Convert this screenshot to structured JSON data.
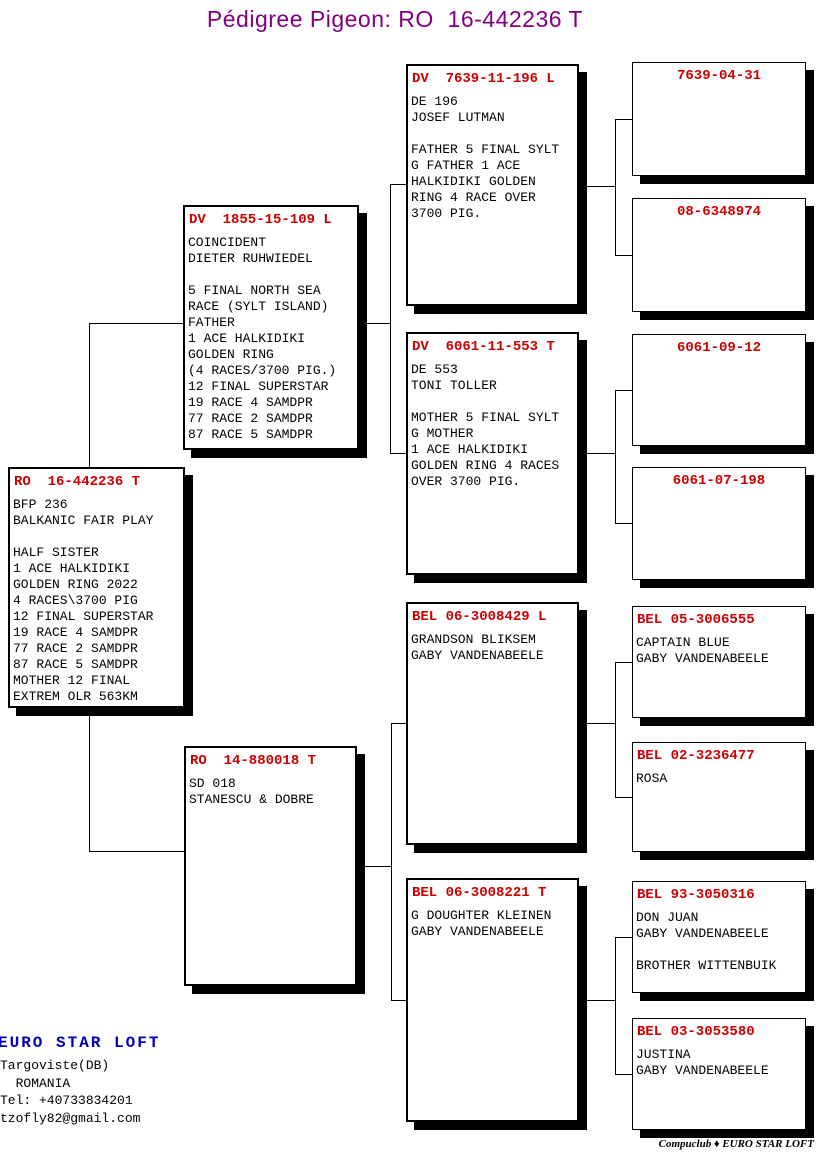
{
  "title": "Pédigree Pigeon: RO  16-442236 T",
  "colors": {
    "title_purple": "#800080",
    "ring_red": "#cc0000",
    "loft_blue": "#0000bb",
    "line_black": "#000000",
    "box_bg": "#ffffff"
  },
  "boxes": {
    "subject": {
      "ring": "RO  16-442236 T",
      "body": "BFP 236\nBALKANIC FAIR PLAY\n\nHALF SISTER\n1 ACE HALKIDIKI\nGOLDEN RING 2022\n4 RACES\\3700 PIG\n12 FINAL SUPERSTAR\n19 RACE 4 SAMDPR\n77 RACE 2 SAMDPR\n87 RACE 5 SAMDPR\nMOTHER 12 FINAL\nEXTREM OLR 563KM"
    },
    "sire": {
      "ring": "DV  1855-15-109 L",
      "body": "COINCIDENT\nDIETER RUHWIEDEL\n\n5 FINAL NORTH SEA\nRACE (SYLT ISLAND)\nFATHER\n1 ACE HALKIDIKI\nGOLDEN RING\n(4 RACES/3700 PIG.)\n12 FINAL SUPERSTAR\n19 RACE 4 SAMDPR\n77 RACE 2 SAMDPR\n87 RACE 5 SAMDPR"
    },
    "dam": {
      "ring": "RO  14-880018 T",
      "body": "SD 018\nSTANESCU & DOBRE"
    },
    "sire_sire": {
      "ring": "DV  7639-11-196 L",
      "body": "DE 196\nJOSEF LUTMAN\n\nFATHER 5 FINAL SYLT\nG FATHER 1 ACE\nHALKIDIKI GOLDEN\nRING 4 RACE OVER\n3700 PIG."
    },
    "sire_dam": {
      "ring": "DV  6061-11-553 T",
      "body": "DE 553\nTONI TOLLER\n\nMOTHER 5 FINAL SYLT\nG MOTHER\n1 ACE HALKIDIKI\nGOLDEN RING 4 RACES\nOVER 3700 PIG."
    },
    "dam_sire": {
      "ring": "BEL 06-3008429 L",
      "body": "GRANDSON BLIKSEM\nGABY VANDENABEELE"
    },
    "dam_dam": {
      "ring": "BEL 06-3008221 T",
      "body": "G DOUGHTER KLEINEN\nGABY VANDENABEELE"
    },
    "gg1": {
      "ring": "7639-04-31",
      "body": ""
    },
    "gg2": {
      "ring": "08-6348974",
      "body": ""
    },
    "gg3": {
      "ring": "6061-09-12",
      "body": ""
    },
    "gg4": {
      "ring": "6061-07-198",
      "body": ""
    },
    "gg5": {
      "ring": "BEL 05-3006555",
      "body": "CAPTAIN BLUE\nGABY VANDENABEELE"
    },
    "gg6": {
      "ring": "BEL 02-3236477",
      "body": "ROSA"
    },
    "gg7": {
      "ring": "BEL 93-3050316",
      "body": "DON JUAN\nGABY VANDENABEELE\n\nBROTHER WITTENBUIK"
    },
    "gg8": {
      "ring": "BEL 03-3053580",
      "body": "JUSTINA\nGABY VANDENABEELE"
    }
  },
  "footer": {
    "loft_name": "EURO STAR LOFT",
    "address": "Targoviste(DB)\n  ROMANIA\nTel: +40733834201\ntzofly82@gmail.com",
    "credit": "Compuclub ♦ EURO STAR LOFT"
  }
}
